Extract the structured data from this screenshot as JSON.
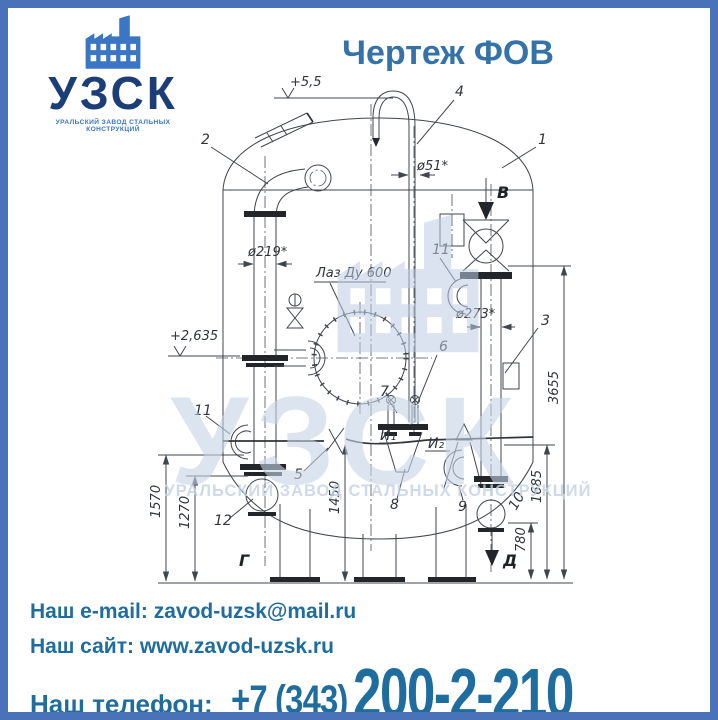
{
  "logo": {
    "name": "УЗСК",
    "subtitle": "УРАЛЬСКИЙ ЗАВОД СТАЛЬНЫХ КОНСТРУКЦИЙ"
  },
  "title": "Чертеж ФОВ",
  "watermark": {
    "name": "УЗСК",
    "subtitle": "УРАЛЬСКИЙ ЗАВОД СТАЛЬНЫХ КОНСТРУКЦИЙ"
  },
  "drawing": {
    "elev_top": "+5,5",
    "elev_mid": "+2,635",
    "manhole": "Лаз Ду 600",
    "dia": {
      "vent": "ø51*",
      "left": "ø219*",
      "right": "ø273*"
    },
    "dims": {
      "right_outer": "3655",
      "right_mid": "1685",
      "right_inner": "780",
      "left_outer": "1570",
      "left_inner": "1270",
      "center": "1450"
    },
    "pos": {
      "p1": "1",
      "p2": "2",
      "p3": "3",
      "p4": "4",
      "p5": "5",
      "p6": "6",
      "p7": "7",
      "p8": "8",
      "p9": "9",
      "p10": "10",
      "p11": "11",
      "p12": "12"
    },
    "markers": {
      "b": "В",
      "g": "Г",
      "d": "Д"
    },
    "points": {
      "i1": "И₁",
      "i2": "И₂"
    }
  },
  "contacts": {
    "email_label": "Наш e-mail:",
    "email": "zavod-uzsk@mail.ru",
    "site_label": "Наш сайт:",
    "site": "www.zavod-uzsk.ru",
    "phone_label": "Наш телефон:",
    "phone_code": "+7 (343)",
    "phone_number": "200-2-210"
  },
  "colors": {
    "frame": "#4a72b8",
    "title": "#3572a8",
    "logo_navy": "#1c3e78",
    "logo_blue": "#3a76c4",
    "contact": "#1e6d9e",
    "watermark": "#bfcfe3"
  }
}
